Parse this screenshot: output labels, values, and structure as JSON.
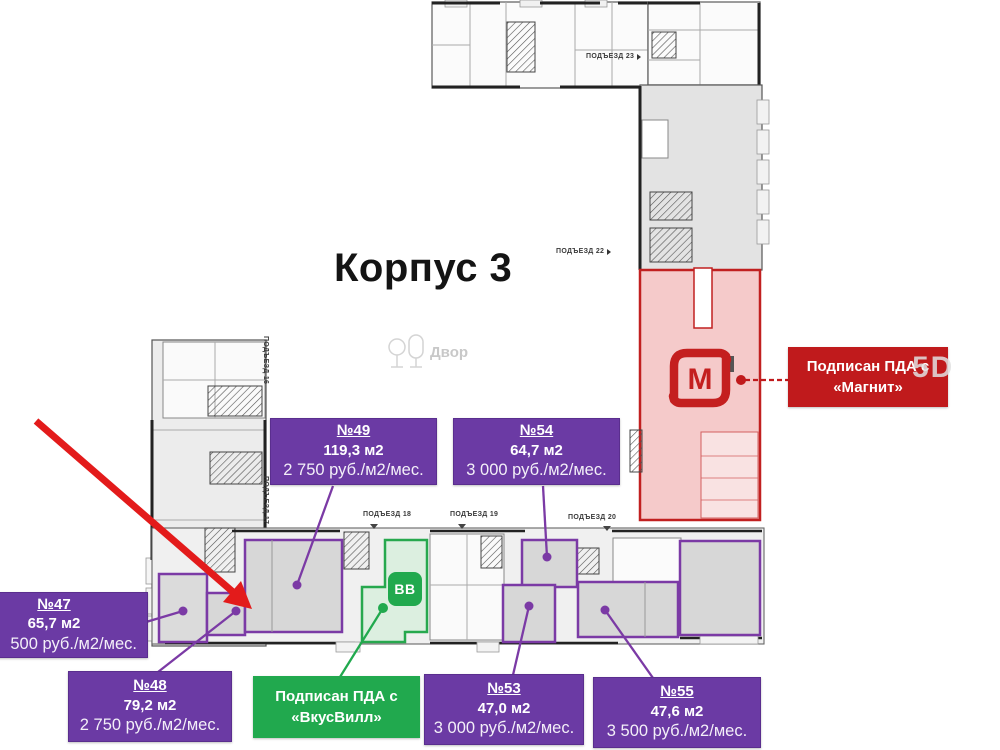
{
  "title": "Корпус 3",
  "courtyard_label": "Двор",
  "watermark": "5D",
  "colors": {
    "purple": "#6b3aa4",
    "green": "#21a94e",
    "red": "#c01a1c",
    "red_unit_fill": "#f5caca",
    "green_unit_fill": "#dcefe0",
    "plan_grey": "#e9e9e9"
  },
  "entrances": {
    "e16": "ПОДЪЕЗД 16",
    "e17": "ПОДЪЕЗД 17",
    "e18": "ПОДЪЕЗД 18",
    "e19": "ПОДЪЕЗД 19",
    "e20": "ПОДЪЕЗД 20",
    "e22": "ПОДЪЕЗД 22",
    "e23": "ПОДЪЕЗД 23"
  },
  "units": {
    "u47": {
      "number": "№47",
      "area": "65,7 м2",
      "price": "500 руб./м2/мес."
    },
    "u48": {
      "number": "№48",
      "area": "79,2 м2",
      "price": "2 750 руб./м2/мес."
    },
    "u49": {
      "number": "№49",
      "area": "119,3 м2",
      "price": "2 750 руб./м2/мес."
    },
    "u53": {
      "number": "№53",
      "area": "47,0 м2",
      "price": "3 000 руб./м2/мес."
    },
    "u54": {
      "number": "№54",
      "area": "64,7 м2",
      "price": "3 000 руб./м2/мес."
    },
    "u55": {
      "number": "№55",
      "area": "47,6 м2",
      "price": "3 500 руб./м2/мес."
    }
  },
  "signed_labels": {
    "magnit": {
      "line1": "Подписан ПДА с",
      "line2": "«Магнит»",
      "logo_letter": "М"
    },
    "vkusvill": {
      "line1": "Подписан ПДА с",
      "line2": "«ВкусВилл»",
      "icon_letters": "ВВ"
    }
  }
}
